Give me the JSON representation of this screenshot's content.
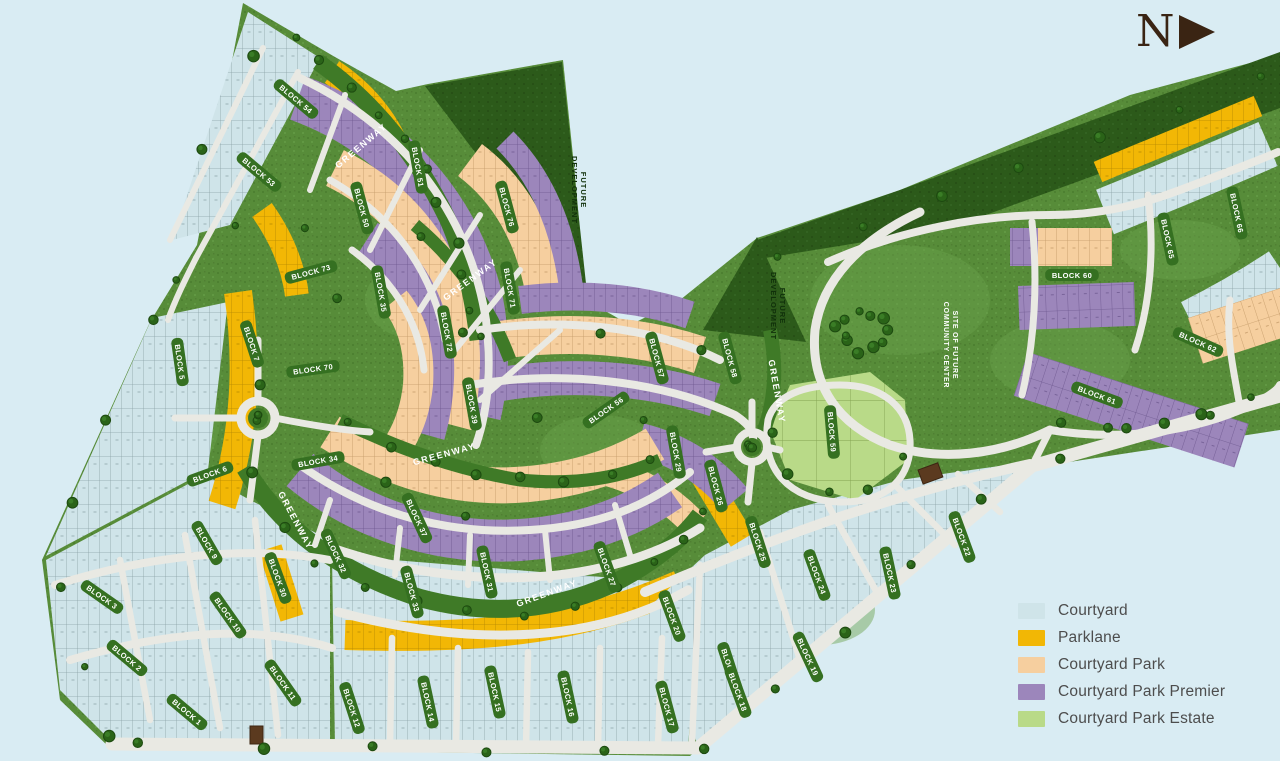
{
  "north_label": "N",
  "legend": {
    "items": [
      {
        "label": "Courtyard",
        "color": "#cfe4e9"
      },
      {
        "label": "Parklane",
        "color": "#f2b705"
      },
      {
        "label": "Courtyard Park",
        "color": "#f6cf9f"
      },
      {
        "label": "Courtyard Park Premier",
        "color": "#9c86bb"
      },
      {
        "label": "Courtyard Park Estate",
        "color": "#b9da88"
      }
    ]
  },
  "labels": {
    "greenway": "GREENWAY",
    "future_line1": "FUTURE",
    "future_line2": "DEVELOPMENT",
    "site_line1": "SITE OF FUTURE",
    "site_line2": "COMMUNITY CENTER"
  },
  "blocks": [
    {
      "label": "BLOCK 54"
    },
    {
      "label": "BLOCK 53"
    },
    {
      "label": "BLOCK 51"
    },
    {
      "label": "BLOCK 50"
    },
    {
      "label": "BLOCK 76"
    },
    {
      "label": "BLOCK 71"
    },
    {
      "label": "BLOCK 73"
    },
    {
      "label": "BLOCK 35"
    },
    {
      "label": "BLOCK 5"
    },
    {
      "label": "BLOCK 7"
    },
    {
      "label": "BLOCK 70"
    },
    {
      "label": "BLOCK 72"
    },
    {
      "label": "BLOCK 39"
    },
    {
      "label": "BLOCK 37"
    },
    {
      "label": "BLOCK 34"
    },
    {
      "label": "BLOCK 6"
    },
    {
      "label": "BLOCK 32"
    },
    {
      "label": "BLOCK 33"
    },
    {
      "label": "BLOCK 31"
    },
    {
      "label": "BLOCK 27"
    },
    {
      "label": "BLOCK 29"
    },
    {
      "label": "BLOCK 26"
    },
    {
      "label": "BLOCK 57"
    },
    {
      "label": "BLOCK 58"
    },
    {
      "label": "BLOCK 56"
    },
    {
      "label": "BLOCK 25"
    },
    {
      "label": "BLOCK 24"
    },
    {
      "label": "BLOCK 23"
    },
    {
      "label": "BLOCK 22"
    },
    {
      "label": "BLOCK 21"
    },
    {
      "label": "BLOCK 20"
    },
    {
      "label": "BLOCK 19"
    },
    {
      "label": "BLOCK 18"
    },
    {
      "label": "BLOCK 17"
    },
    {
      "label": "BLOCK 16"
    },
    {
      "label": "BLOCK 15"
    },
    {
      "label": "BLOCK 14"
    },
    {
      "label": "BLOCK 12"
    },
    {
      "label": "BLOCK 11"
    },
    {
      "label": "BLOCK 10"
    },
    {
      "label": "BLOCK 9"
    },
    {
      "label": "BLOCK 3"
    },
    {
      "label": "BLOCK 2"
    },
    {
      "label": "BLOCK 1"
    },
    {
      "label": "BLOCK 59"
    },
    {
      "label": "BLOCK 60"
    },
    {
      "label": "BLOCK 61"
    },
    {
      "label": "BLOCK 62"
    },
    {
      "label": "BLOCK 65"
    },
    {
      "label": "BLOCK 66"
    },
    {
      "label": "BLOCK 30"
    }
  ],
  "colors": {
    "background": "#d9ecf3",
    "grass": "#578c39",
    "dark_green": "#2c5a1a",
    "greenway_strip": "#3f7a27",
    "road": "#e9e9e3",
    "north_arrow": "#3a2413",
    "monument": "#5b3a1f"
  }
}
